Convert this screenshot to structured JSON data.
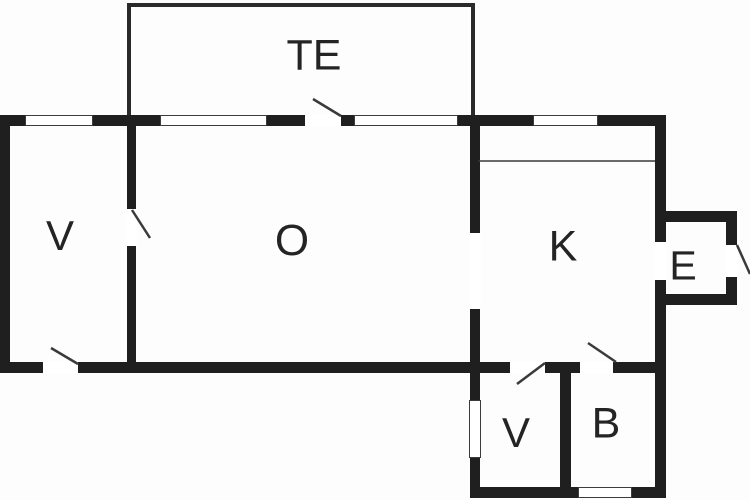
{
  "drawing": {
    "kind": "floor-plan",
    "canvas": {
      "width": 750,
      "height": 500
    },
    "colors": {
      "wall": "#1f1f1f",
      "thin_wall": "#2a2a2a",
      "background": "#fdfdfd",
      "line": "#3a3a3a",
      "label": "#242424"
    }
  },
  "rooms": [
    {
      "id": "room-te",
      "label": "TE",
      "cx": 314,
      "cy": 56,
      "font_size": 43
    },
    {
      "id": "room-v-left",
      "label": "V",
      "cx": 60,
      "cy": 236,
      "font_size": 42
    },
    {
      "id": "room-o",
      "label": "O",
      "cx": 292,
      "cy": 241,
      "font_size": 44
    },
    {
      "id": "room-k",
      "label": "K",
      "cx": 563,
      "cy": 247,
      "font_size": 43
    },
    {
      "id": "room-e",
      "label": "E",
      "cx": 683,
      "cy": 266,
      "font_size": 41
    },
    {
      "id": "room-v-ext",
      "label": "V",
      "cx": 516,
      "cy": 433,
      "font_size": 42
    },
    {
      "id": "room-b",
      "label": "B",
      "cx": 606,
      "cy": 424,
      "font_size": 43
    }
  ],
  "walls": [
    {
      "id": "top-wall",
      "x": 0,
      "y": 115,
      "w": 666,
      "h": 11
    },
    {
      "id": "left-wall",
      "x": 0,
      "y": 115,
      "w": 10,
      "h": 258
    },
    {
      "id": "bottom-wall-main",
      "x": 0,
      "y": 362,
      "w": 481,
      "h": 11
    },
    {
      "id": "right-wall",
      "x": 655,
      "y": 115,
      "w": 11,
      "h": 383
    },
    {
      "id": "v-o-wall",
      "x": 127,
      "y": 126,
      "w": 9,
      "h": 237
    },
    {
      "id": "o-k-ext-wall",
      "x": 470,
      "y": 126,
      "w": 10,
      "h": 372
    },
    {
      "id": "ext-top-wall",
      "x": 480,
      "y": 362,
      "w": 186,
      "h": 11
    },
    {
      "id": "ext-bottom-wall",
      "x": 470,
      "y": 487,
      "w": 196,
      "h": 11
    },
    {
      "id": "v-b-divider",
      "x": 560,
      "y": 373,
      "w": 11,
      "h": 114
    },
    {
      "id": "e-top-wall",
      "x": 655,
      "y": 211,
      "w": 82,
      "h": 11
    },
    {
      "id": "e-right-wall",
      "x": 726,
      "y": 211,
      "w": 11,
      "h": 94
    },
    {
      "id": "e-bottom-wall",
      "x": 655,
      "y": 294,
      "w": 82,
      "h": 11
    }
  ],
  "thin_walls": [
    {
      "id": "te-left-wall",
      "x": 127,
      "y": 3,
      "w": 4,
      "h": 112
    },
    {
      "id": "te-top-wall",
      "x": 127,
      "y": 3,
      "w": 348,
      "h": 4
    },
    {
      "id": "te-right-wall",
      "x": 471,
      "y": 3,
      "w": 4,
      "h": 112
    }
  ],
  "openings": [
    {
      "id": "door-opening-te",
      "x": 305,
      "y": 114,
      "w": 36,
      "h": 13
    },
    {
      "id": "door-opening-v-o",
      "x": 126,
      "y": 209,
      "w": 11,
      "h": 37
    },
    {
      "id": "door-opening-entry",
      "x": 43,
      "y": 361,
      "w": 35,
      "h": 13
    },
    {
      "id": "passage-o-k",
      "x": 469,
      "y": 233,
      "w": 12,
      "h": 76
    },
    {
      "id": "door-opening-ext-v",
      "x": 510,
      "y": 361,
      "w": 35,
      "h": 13
    },
    {
      "id": "door-opening-b",
      "x": 580,
      "y": 361,
      "w": 33,
      "h": 13
    },
    {
      "id": "passage-k-e",
      "x": 654,
      "y": 242,
      "w": 13,
      "h": 38
    },
    {
      "id": "door-opening-e-exterior",
      "x": 725,
      "y": 245,
      "w": 13,
      "h": 32
    }
  ],
  "windows": [
    {
      "id": "window-top-1",
      "x": 25,
      "y": 115,
      "w": 68,
      "h": 11
    },
    {
      "id": "window-top-2",
      "x": 160,
      "y": 115,
      "w": 107,
      "h": 11
    },
    {
      "id": "window-top-3",
      "x": 354,
      "y": 115,
      "w": 104,
      "h": 11
    },
    {
      "id": "window-top-4",
      "x": 533,
      "y": 115,
      "w": 65,
      "h": 11
    },
    {
      "id": "window-ext-left",
      "x": 469,
      "y": 400,
      "w": 12,
      "h": 58
    },
    {
      "id": "window-ext-bottom",
      "x": 578,
      "y": 487,
      "w": 54,
      "h": 11
    }
  ],
  "door_swings": [
    {
      "id": "swing-te",
      "x1": 313,
      "y1": 99,
      "x2": 341,
      "y2": 116
    },
    {
      "id": "swing-v-o",
      "x1": 132,
      "y1": 210,
      "x2": 150,
      "y2": 238
    },
    {
      "id": "swing-entry",
      "x1": 51,
      "y1": 348,
      "x2": 78,
      "y2": 364
    },
    {
      "id": "swing-ext-v",
      "x1": 517,
      "y1": 384,
      "x2": 545,
      "y2": 363
    },
    {
      "id": "swing-b",
      "x1": 588,
      "y1": 343,
      "x2": 616,
      "y2": 362
    },
    {
      "id": "swing-e-exterior",
      "x1": 737,
      "y1": 245,
      "x2": 750,
      "y2": 274
    }
  ],
  "fixtures": [
    {
      "id": "kitchen-counter-line",
      "x1": 478,
      "y1": 161,
      "x2": 655,
      "y2": 161
    }
  ]
}
